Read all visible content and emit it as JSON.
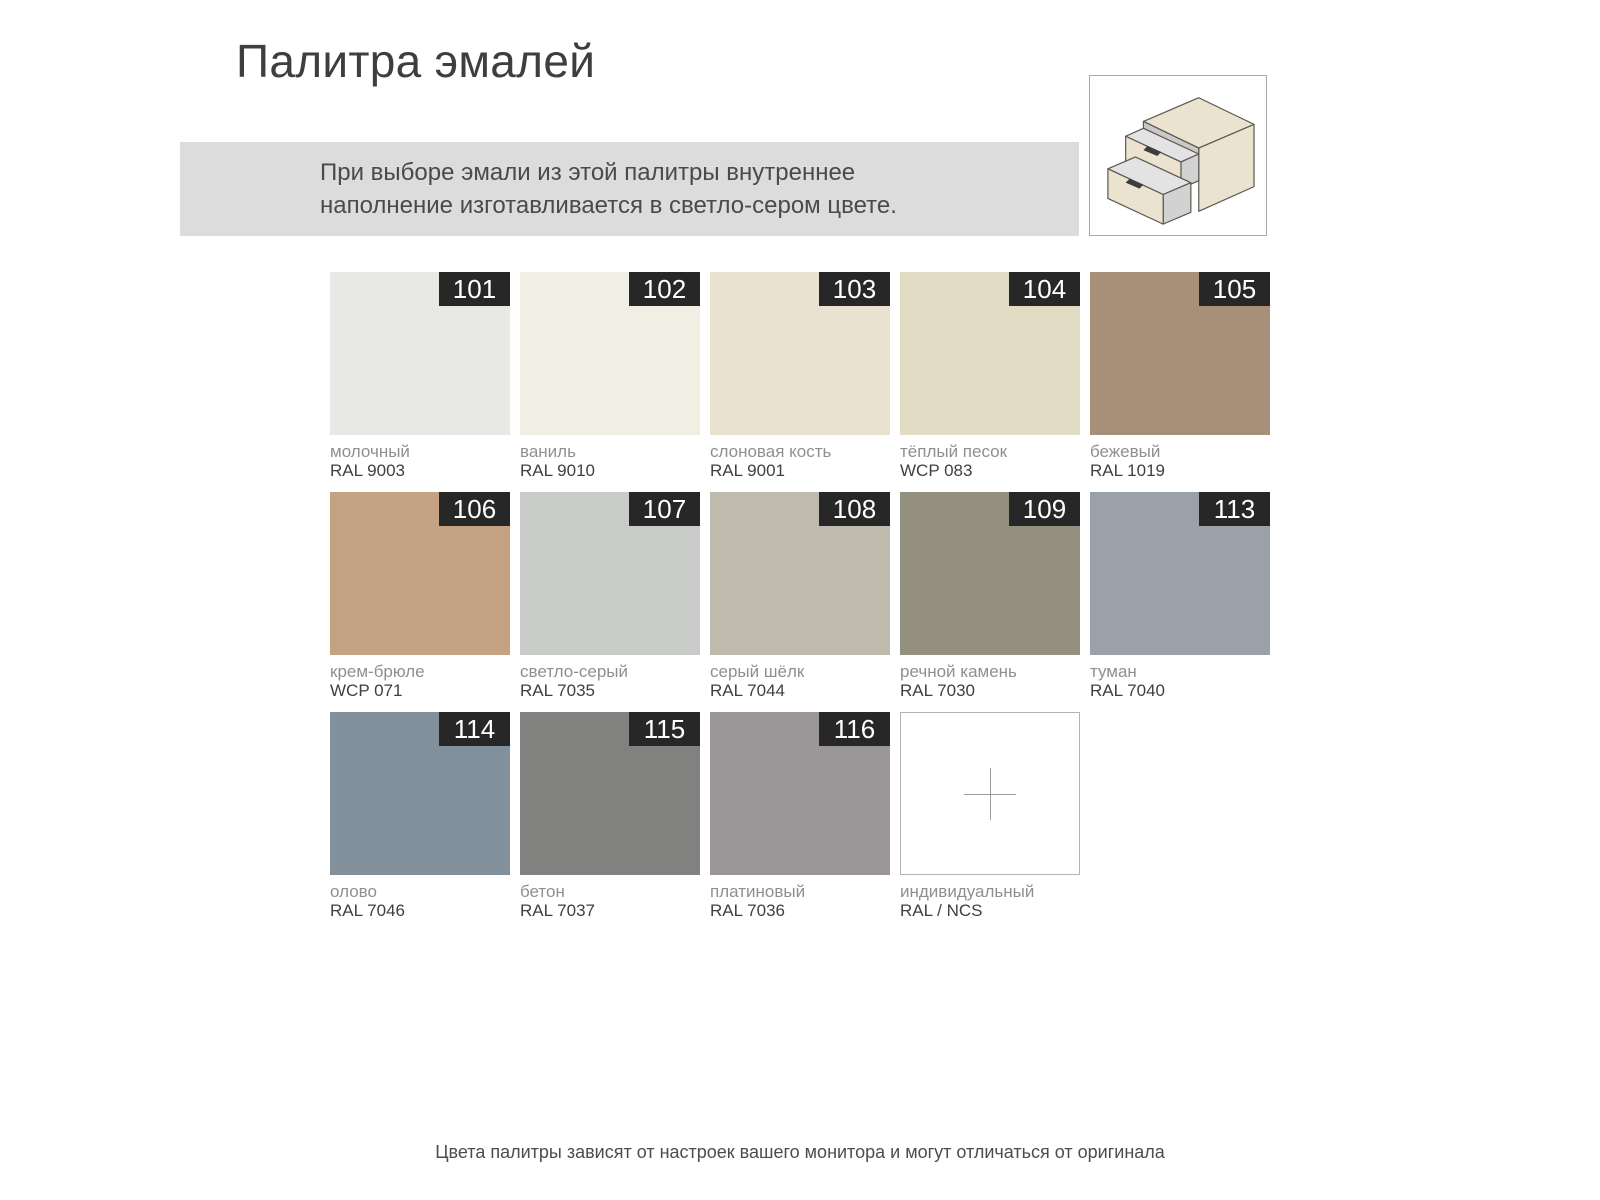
{
  "header": {
    "title": "Палитра эмалей"
  },
  "note": {
    "text": "При выборе эмали из этой палитры внутреннее наполнение изготавливается в светло-сером цвете."
  },
  "palette": {
    "swatches": [
      {
        "id": "101",
        "name": "молочный",
        "code": "RAL 9003",
        "color": "#e8e9e4"
      },
      {
        "id": "102",
        "name": "ваниль",
        "code": "RAL 9010",
        "color": "#f1efe4"
      },
      {
        "id": "103",
        "name": "слоновая кость",
        "code": "RAL 9001",
        "color": "#e9e2d0"
      },
      {
        "id": "104",
        "name": "тёплый песок",
        "code": "WCP 083",
        "color": "#e3dcc4"
      },
      {
        "id": "105",
        "name": "бежевый",
        "code": "RAL 1019",
        "color": "#a78f7a"
      },
      {
        "id": "106",
        "name": "крем-брюле",
        "code": "WCP 071",
        "color": "#c5a284"
      },
      {
        "id": "107",
        "name": "светло-серый",
        "code": "RAL 7035",
        "color": "#c8cbc8"
      },
      {
        "id": "108",
        "name": "серый шёлк",
        "code": "RAL 7044",
        "color": "#bebaad"
      },
      {
        "id": "109",
        "name": "речной камень",
        "code": "RAL 7030",
        "color": "#93907f"
      },
      {
        "id": "113",
        "name": "туман",
        "code": "RAL 7040",
        "color": "#9aa1a8"
      },
      {
        "id": "114",
        "name": "олово",
        "code": "RAL 7046",
        "color": "#82909b"
      },
      {
        "id": "115",
        "name": "бетон",
        "code": "RAL 7037",
        "color": "#818180"
      },
      {
        "id": "116",
        "name": "платиновый",
        "code": "RAL 7036",
        "color": "#9b9697"
      },
      {
        "id": "",
        "name": "индивидуальный",
        "code": "RAL / NCS",
        "color": "#ffffff",
        "custom": true
      }
    ]
  },
  "colors": {
    "badge_bg": "#272727",
    "badge_text": "#ffffff",
    "note_bg": "#dcdcdc",
    "page_bg": "#ffffff",
    "illustration_beige": "#ebe3cf",
    "label_name_text": "#8f8f8f",
    "label_code_text": "#3f3f3f"
  },
  "footer": {
    "text": "Цвета палитры зависят от настроек вашего монитора и могут отличаться от оригинала"
  }
}
